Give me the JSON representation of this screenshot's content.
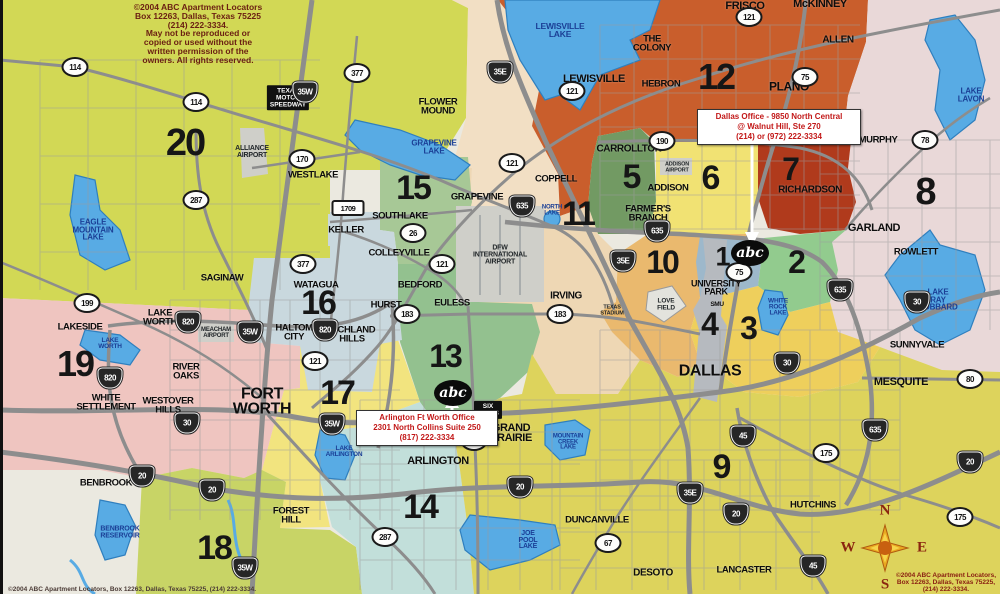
{
  "palette": {
    "water": "#58abe4",
    "water_edge": "#2f7fbe",
    "road": "#8d8d8d",
    "road_minor": "#9d9d9d",
    "bg": "#ebe9e0",
    "peach": "#f2dfc4",
    "airport_gray": "#cfcfc9",
    "edge_bar": "#111111"
  },
  "zones": [
    {
      "n": "1",
      "x": 722,
      "y": 257,
      "fs": 27,
      "color": "#9db8cb"
    },
    {
      "n": "2",
      "x": 796,
      "y": 262,
      "fs": 32,
      "color": "#92cb8e"
    },
    {
      "n": "3",
      "x": 748,
      "y": 328,
      "fs": 32,
      "color": "#eecf5c"
    },
    {
      "n": "4",
      "x": 709,
      "y": 324,
      "fs": 32,
      "color": "#b6babf"
    },
    {
      "n": "5",
      "x": 631,
      "y": 177,
      "fs": 34,
      "color": "#729a63"
    },
    {
      "n": "6",
      "x": 710,
      "y": 178,
      "fs": 34,
      "color": "#f1e273"
    },
    {
      "n": "7",
      "x": 790,
      "y": 169,
      "fs": 32,
      "color": "#b03a1c"
    },
    {
      "n": "8",
      "x": 925,
      "y": 192,
      "fs": 38,
      "color": "#e9d8d8"
    },
    {
      "n": "9",
      "x": 721,
      "y": 467,
      "fs": 34,
      "color": "#ddd35c"
    },
    {
      "n": "10",
      "x": 662,
      "y": 262,
      "fs": 32,
      "color": "#eab96e"
    },
    {
      "n": "11",
      "x": 578,
      "y": 214,
      "fs": 34,
      "color": "#eed7b4"
    },
    {
      "n": "12",
      "x": 716,
      "y": 77,
      "fs": 36,
      "color": "#c95e2c"
    },
    {
      "n": "13",
      "x": 445,
      "y": 356,
      "fs": 32,
      "color": "#93c18f"
    },
    {
      "n": "14",
      "x": 420,
      "y": 507,
      "fs": 34,
      "color": "#c2dfda"
    },
    {
      "n": "15",
      "x": 413,
      "y": 188,
      "fs": 34,
      "color": "#a7c896"
    },
    {
      "n": "16",
      "x": 318,
      "y": 303,
      "fs": 34,
      "color": "#c9d8de"
    },
    {
      "n": "17",
      "x": 337,
      "y": 393,
      "fs": 34,
      "color": "#f2e47f"
    },
    {
      "n": "18",
      "x": 214,
      "y": 548,
      "fs": 34,
      "color": "#c8d466"
    },
    {
      "n": "19",
      "x": 75,
      "y": 364,
      "fs": 36,
      "color": "#efc5c0"
    },
    {
      "n": "20",
      "x": 185,
      "y": 143,
      "fs": 38,
      "color": "#d2d855"
    }
  ],
  "cities": [
    {
      "name": "FRISCO",
      "x": 745,
      "y": 6,
      "fs": 11
    },
    {
      "name": "McKINNEY",
      "x": 820,
      "y": 4,
      "fs": 11
    },
    {
      "name": "ALLEN",
      "x": 838,
      "y": 40,
      "fs": 10
    },
    {
      "name": "THE\nCOLONY",
      "x": 652,
      "y": 44,
      "fs": 9.5
    },
    {
      "name": "LEWISVILLE",
      "x": 594,
      "y": 79,
      "fs": 11
    },
    {
      "name": "HEBRON",
      "x": 661,
      "y": 85,
      "fs": 9.5
    },
    {
      "name": "PLANO",
      "x": 789,
      "y": 87,
      "fs": 12
    },
    {
      "name": "MURPHY",
      "x": 878,
      "y": 141,
      "fs": 9.5
    },
    {
      "name": "CARROLLTON",
      "x": 629,
      "y": 149,
      "fs": 10
    },
    {
      "name": "ADDISON",
      "x": 668,
      "y": 189,
      "fs": 9.5
    },
    {
      "name": "RICHARDSON",
      "x": 810,
      "y": 190,
      "fs": 10
    },
    {
      "name": "FARMER'S\nBRANCH",
      "x": 648,
      "y": 214,
      "fs": 9.5
    },
    {
      "name": "COPPELL",
      "x": 556,
      "y": 180,
      "fs": 9.5
    },
    {
      "name": "FLOWER\nMOUND",
      "x": 438,
      "y": 107,
      "fs": 9.5
    },
    {
      "name": "GRAPEVINE",
      "x": 477,
      "y": 198,
      "fs": 9.5
    },
    {
      "name": "WESTLAKE",
      "x": 313,
      "y": 176,
      "fs": 9.5
    },
    {
      "name": "SOUTHLAKE",
      "x": 400,
      "y": 217,
      "fs": 9.5
    },
    {
      "name": "KELLER",
      "x": 346,
      "y": 231,
      "fs": 9.5
    },
    {
      "name": "COLLEYVILLE",
      "x": 399,
      "y": 254,
      "fs": 9.5
    },
    {
      "name": "GARLAND",
      "x": 874,
      "y": 228,
      "fs": 11
    },
    {
      "name": "ROWLETT",
      "x": 916,
      "y": 253,
      "fs": 9.5
    },
    {
      "name": "SAGINAW",
      "x": 222,
      "y": 279,
      "fs": 9.5
    },
    {
      "name": "WATAGUA",
      "x": 316,
      "y": 286,
      "fs": 9.5
    },
    {
      "name": "BEDFORD",
      "x": 420,
      "y": 286,
      "fs": 9.5
    },
    {
      "name": "HURST",
      "x": 386,
      "y": 306,
      "fs": 9.5
    },
    {
      "name": "EULESS",
      "x": 452,
      "y": 304,
      "fs": 9.5
    },
    {
      "name": "IRVING",
      "x": 566,
      "y": 296,
      "fs": 10
    },
    {
      "name": "UNIVERSITY\nPARK",
      "x": 716,
      "y": 288,
      "fs": 9
    },
    {
      "name": "SMU",
      "x": 717,
      "y": 305,
      "fs": 6.5
    },
    {
      "name": "LAKE\nWORTH",
      "x": 160,
      "y": 318,
      "fs": 9.5
    },
    {
      "name": "LAKESIDE",
      "x": 80,
      "y": 328,
      "fs": 9.5
    },
    {
      "name": "HALTOM\nCITY",
      "x": 294,
      "y": 333,
      "fs": 9.5
    },
    {
      "name": "RICHLAND\nHILLS",
      "x": 352,
      "y": 335,
      "fs": 9.5
    },
    {
      "name": "SUNNYVALE",
      "x": 917,
      "y": 346,
      "fs": 9.5
    },
    {
      "name": "RIVER\nOAKS",
      "x": 186,
      "y": 372,
      "fs": 9.5
    },
    {
      "name": "DALLAS",
      "x": 710,
      "y": 372,
      "fs": 16
    },
    {
      "name": "MESQUITE",
      "x": 901,
      "y": 382,
      "fs": 11
    },
    {
      "name": "WESTOVER\nHILLS",
      "x": 168,
      "y": 406,
      "fs": 9.5
    },
    {
      "name": "WHITE\nSETTLEMENT",
      "x": 106,
      "y": 403,
      "fs": 9.5
    },
    {
      "name": "FORT\nWORTH",
      "x": 262,
      "y": 402,
      "fs": 16
    },
    {
      "name": "GRAND\nPRAIRIE",
      "x": 511,
      "y": 433,
      "fs": 11
    },
    {
      "name": "ARLINGTON",
      "x": 438,
      "y": 461,
      "fs": 11
    },
    {
      "name": "BENBROOK",
      "x": 106,
      "y": 484,
      "fs": 9.5
    },
    {
      "name": "HUTCHINS",
      "x": 813,
      "y": 506,
      "fs": 9.5
    },
    {
      "name": "FOREST\nHILL",
      "x": 291,
      "y": 516,
      "fs": 9.5
    },
    {
      "name": "DUNCANVILLE",
      "x": 597,
      "y": 521,
      "fs": 9.5
    },
    {
      "name": "DESOTO",
      "x": 653,
      "y": 573,
      "fs": 10
    },
    {
      "name": "LANCASTER",
      "x": 744,
      "y": 571,
      "fs": 9.5
    }
  ],
  "lake_labels": [
    {
      "name": "LEWISVILLE\nLAKE",
      "x": 560,
      "y": 30,
      "fs": 8.5
    },
    {
      "name": "LAKE\nLAVON",
      "x": 971,
      "y": 95,
      "fs": 8
    },
    {
      "name": "GRAPEVINE\nLAKE",
      "x": 434,
      "y": 147,
      "fs": 8
    },
    {
      "name": "NORTH\nLAKE",
      "x": 552,
      "y": 211,
      "fs": 6
    },
    {
      "name": "EAGLE\nMOUNTAIN\nLAKE",
      "x": 93,
      "y": 230,
      "fs": 8
    },
    {
      "name": "LAKE\nWORTH",
      "x": 110,
      "y": 344,
      "fs": 6.5
    },
    {
      "name": "WHITE\nROCK\nLAKE",
      "x": 778,
      "y": 308,
      "fs": 6.5
    },
    {
      "name": "LAKE\nRAY\nHUBBARD",
      "x": 938,
      "y": 300,
      "fs": 8
    },
    {
      "name": "LAKE\nARLINGTON",
      "x": 344,
      "y": 452,
      "fs": 6.5
    },
    {
      "name": "MOUNTAIN\nCREEK\nLAKE",
      "x": 568,
      "y": 443,
      "fs": 6
    },
    {
      "name": "JOE\nPOOL\nLAKE",
      "x": 528,
      "y": 541,
      "fs": 7
    },
    {
      "name": "BENBROOK\nRESERVOIR",
      "x": 120,
      "y": 533,
      "fs": 7
    }
  ],
  "airport_labels": [
    {
      "name": "ALLIANCE\nAIRPORT",
      "x": 252,
      "y": 152,
      "fs": 7
    },
    {
      "name": "DFW\nINTERNATIONAL\nAIRPORT",
      "x": 500,
      "y": 255,
      "fs": 7
    },
    {
      "name": "MEACHAM\nAIRPORT",
      "x": 216,
      "y": 333,
      "fs": 6
    },
    {
      "name": "ADDISON\nAIRPORT",
      "x": 677,
      "y": 168,
      "fs": 5.5
    },
    {
      "name": "LOVE\nFIELD",
      "x": 666,
      "y": 305,
      "fs": 6.5
    },
    {
      "name": "TEXAS\nSTADIUM",
      "x": 612,
      "y": 311,
      "fs": 5.5
    }
  ],
  "landmarks": [
    {
      "name": "TEXAS\nMOTOR\nSPEEDWAY",
      "x": 288,
      "y": 98,
      "fs": 6.5
    },
    {
      "name": "SIX\nFLAGS",
      "x": 488,
      "y": 410,
      "fs": 6.5
    }
  ],
  "highways": [
    {
      "t": "c",
      "n": "114",
      "x": 75,
      "y": 67
    },
    {
      "t": "c",
      "n": "114",
      "x": 196,
      "y": 102
    },
    {
      "t": "c",
      "n": "377",
      "x": 357,
      "y": 73
    },
    {
      "t": "i",
      "n": "35W",
      "x": 305,
      "y": 92
    },
    {
      "t": "i",
      "n": "35E",
      "x": 500,
      "y": 72
    },
    {
      "t": "c",
      "n": "121",
      "x": 572,
      "y": 91
    },
    {
      "t": "c",
      "n": "75",
      "x": 805,
      "y": 77
    },
    {
      "t": "c",
      "n": "121",
      "x": 749,
      "y": 17
    },
    {
      "t": "c",
      "n": "170",
      "x": 302,
      "y": 159
    },
    {
      "t": "c",
      "n": "121",
      "x": 512,
      "y": 163
    },
    {
      "t": "c",
      "n": "190",
      "x": 662,
      "y": 141
    },
    {
      "t": "c",
      "n": "78",
      "x": 925,
      "y": 140
    },
    {
      "t": "c",
      "n": "287",
      "x": 196,
      "y": 200
    },
    {
      "t": "r",
      "n": "1709",
      "x": 348,
      "y": 208
    },
    {
      "t": "i",
      "n": "635",
      "x": 522,
      "y": 206
    },
    {
      "t": "i",
      "n": "635",
      "x": 657,
      "y": 231
    },
    {
      "t": "c",
      "n": "26",
      "x": 413,
      "y": 233
    },
    {
      "t": "i",
      "n": "35E",
      "x": 623,
      "y": 261
    },
    {
      "t": "c",
      "n": "121",
      "x": 442,
      "y": 264
    },
    {
      "t": "c",
      "n": "377",
      "x": 303,
      "y": 264
    },
    {
      "t": "c",
      "n": "75",
      "x": 739,
      "y": 272
    },
    {
      "t": "i",
      "n": "635",
      "x": 840,
      "y": 290
    },
    {
      "t": "i",
      "n": "30",
      "x": 917,
      "y": 302
    },
    {
      "t": "c",
      "n": "199",
      "x": 87,
      "y": 303
    },
    {
      "t": "c",
      "n": "183",
      "x": 407,
      "y": 314
    },
    {
      "t": "c",
      "n": "183",
      "x": 560,
      "y": 314
    },
    {
      "t": "i",
      "n": "820",
      "x": 188,
      "y": 322
    },
    {
      "t": "i",
      "n": "820",
      "x": 325,
      "y": 330
    },
    {
      "t": "i",
      "n": "35W",
      "x": 250,
      "y": 332
    },
    {
      "t": "c",
      "n": "121",
      "x": 315,
      "y": 361
    },
    {
      "t": "i",
      "n": "30",
      "x": 787,
      "y": 363
    },
    {
      "t": "i",
      "n": "820",
      "x": 110,
      "y": 378
    },
    {
      "t": "c",
      "n": "80",
      "x": 970,
      "y": 379
    },
    {
      "t": "i",
      "n": "30",
      "x": 187,
      "y": 423
    },
    {
      "t": "i",
      "n": "35W",
      "x": 332,
      "y": 424
    },
    {
      "t": "i",
      "n": "635",
      "x": 875,
      "y": 430
    },
    {
      "t": "i",
      "n": "45",
      "x": 743,
      "y": 436
    },
    {
      "t": "c",
      "n": "360",
      "x": 474,
      "y": 441
    },
    {
      "t": "c",
      "n": "175",
      "x": 826,
      "y": 453
    },
    {
      "t": "i",
      "n": "20",
      "x": 970,
      "y": 462
    },
    {
      "t": "i",
      "n": "20",
      "x": 142,
      "y": 476
    },
    {
      "t": "i",
      "n": "20",
      "x": 520,
      "y": 487
    },
    {
      "t": "i",
      "n": "20",
      "x": 212,
      "y": 490
    },
    {
      "t": "i",
      "n": "35E",
      "x": 690,
      "y": 493
    },
    {
      "t": "i",
      "n": "20",
      "x": 736,
      "y": 514
    },
    {
      "t": "c",
      "n": "175",
      "x": 960,
      "y": 517
    },
    {
      "t": "c",
      "n": "287",
      "x": 385,
      "y": 537
    },
    {
      "t": "c",
      "n": "67",
      "x": 608,
      "y": 543
    },
    {
      "t": "i",
      "n": "45",
      "x": 813,
      "y": 566
    },
    {
      "t": "i",
      "n": "35W",
      "x": 245,
      "y": 568
    }
  ],
  "offices": {
    "dallas": {
      "text": "Dallas Office - 9850 North Central\n@ Walnut Hill, Ste 270\n(214) or (972) 222-3334"
    },
    "arlington": {
      "text": "Arlington Ft Worth Office\n2301 North Collins Suite 250\n(817) 222-3334"
    }
  },
  "markers": [
    {
      "label": "abc"
    },
    {
      "label": "abc"
    }
  ],
  "compass": {
    "n": "N",
    "s": "S",
    "e": "E",
    "w": "W"
  },
  "copyright": {
    "top": "©2004 ABC Apartment Locators\nBox 12263, Dallas, Texas 75225\n(214) 222-3334.\nMay not be reproduced or\ncopied or used without the\nwritten permission of the\nowners. All rights reserved.",
    "bottom_left": "©2004 ABC Apartment Locators, Box 12263, Dallas, Texas 75225, (214) 222-3334.",
    "bottom_right": "©2004 ABC Apartment Locators,\nBox 12263, Dallas, Texas 75225,\n(214) 222-3334."
  }
}
